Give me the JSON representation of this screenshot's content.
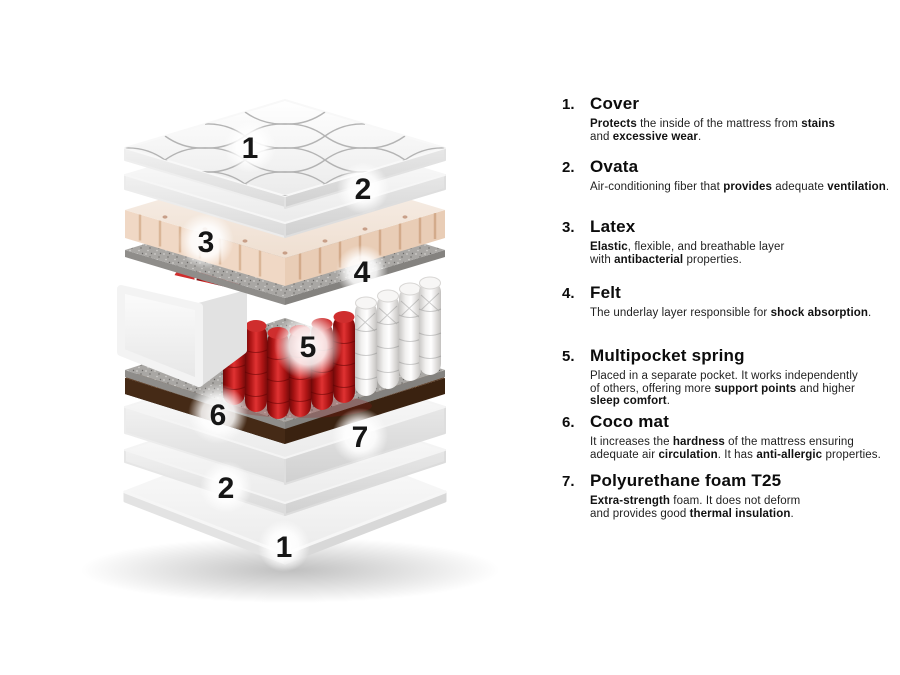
{
  "page": {
    "background": "#ffffff"
  },
  "diagram": {
    "name": "mattress-exploded-view",
    "labels": [
      {
        "text": "1",
        "x": 250,
        "y": 147,
        "glow": 26
      },
      {
        "text": "2",
        "x": 363,
        "y": 188,
        "glow": 26
      },
      {
        "text": "3",
        "x": 206,
        "y": 241,
        "glow": 28
      },
      {
        "text": "4",
        "x": 362,
        "y": 271,
        "glow": 26
      },
      {
        "text": "5",
        "x": 308,
        "y": 346,
        "glow": 34
      },
      {
        "text": "6",
        "x": 218,
        "y": 414,
        "glow": 30
      },
      {
        "text": "7",
        "x": 360,
        "y": 436,
        "glow": 28
      },
      {
        "text": "2",
        "x": 226,
        "y": 487,
        "glow": 26
      },
      {
        "text": "1",
        "x": 284,
        "y": 546,
        "glow": 26
      }
    ],
    "layers": [
      {
        "name": "cover",
        "color": "#f5f5f5"
      },
      {
        "name": "ovata",
        "color": "#fafafa"
      },
      {
        "name": "latex",
        "color": "#eed3be"
      },
      {
        "name": "felt",
        "color": "#a9a7a4"
      },
      {
        "name": "multipocket-spring",
        "color": "#c31d1d"
      },
      {
        "name": "coco-mat",
        "color": "#5f3c23"
      },
      {
        "name": "polyurethane-foam",
        "color": "#f2f2f2"
      }
    ]
  },
  "legend": {
    "items": [
      {
        "number": "1.",
        "title": "Cover",
        "desc": [
          {
            "t": "Protects",
            "b": true
          },
          {
            "t": " the inside of the mattress from "
          },
          {
            "t": "stains",
            "b": true
          },
          {
            "br": true
          },
          {
            "t": "and "
          },
          {
            "t": "excessive wear",
            "b": true
          },
          {
            "t": "."
          }
        ]
      },
      {
        "number": "2.",
        "title": "Ovata",
        "desc": [
          {
            "t": "Air-conditioning fiber that "
          },
          {
            "t": "provides",
            "b": true
          },
          {
            "t": " adequate "
          },
          {
            "t": "ventilation",
            "b": true
          },
          {
            "t": "."
          }
        ]
      },
      {
        "number": "3.",
        "title": "Latex",
        "desc": [
          {
            "t": "Elastic",
            "b": true
          },
          {
            "t": ", flexible, and breathable layer"
          },
          {
            "br": true
          },
          {
            "t": "with "
          },
          {
            "t": "antibacterial",
            "b": true
          },
          {
            "t": " properties."
          }
        ]
      },
      {
        "number": "4.",
        "title": "Felt",
        "desc": [
          {
            "t": "The underlay layer responsible for "
          },
          {
            "t": "shock absorption",
            "b": true
          },
          {
            "t": "."
          }
        ]
      },
      {
        "number": "5.",
        "title": "Multipocket spring",
        "desc": [
          {
            "t": "Placed in a separate pocket. It works independently"
          },
          {
            "br": true
          },
          {
            "t": "of others, offering more "
          },
          {
            "t": "support points",
            "b": true
          },
          {
            "t": " and higher"
          },
          {
            "br": true
          },
          {
            "t": "sleep comfort",
            "b": true
          },
          {
            "t": "."
          }
        ]
      },
      {
        "number": "6.",
        "title": "Coco mat",
        "desc": [
          {
            "t": "It increases the "
          },
          {
            "t": "hardness",
            "b": true
          },
          {
            "t": " of the mattress ensuring"
          },
          {
            "br": true
          },
          {
            "t": "adequate air "
          },
          {
            "t": "circulation",
            "b": true
          },
          {
            "t": ". It has "
          },
          {
            "t": "anti-allergic",
            "b": true
          },
          {
            "t": " properties."
          }
        ]
      },
      {
        "number": "7.",
        "title": "Polyurethane foam T25",
        "desc": [
          {
            "t": "Extra-strength",
            "b": true
          },
          {
            "t": " foam. It does not deform"
          },
          {
            "br": true
          },
          {
            "t": "and provides good "
          },
          {
            "t": "thermal insulation",
            "b": true
          },
          {
            "t": "."
          }
        ]
      }
    ]
  }
}
